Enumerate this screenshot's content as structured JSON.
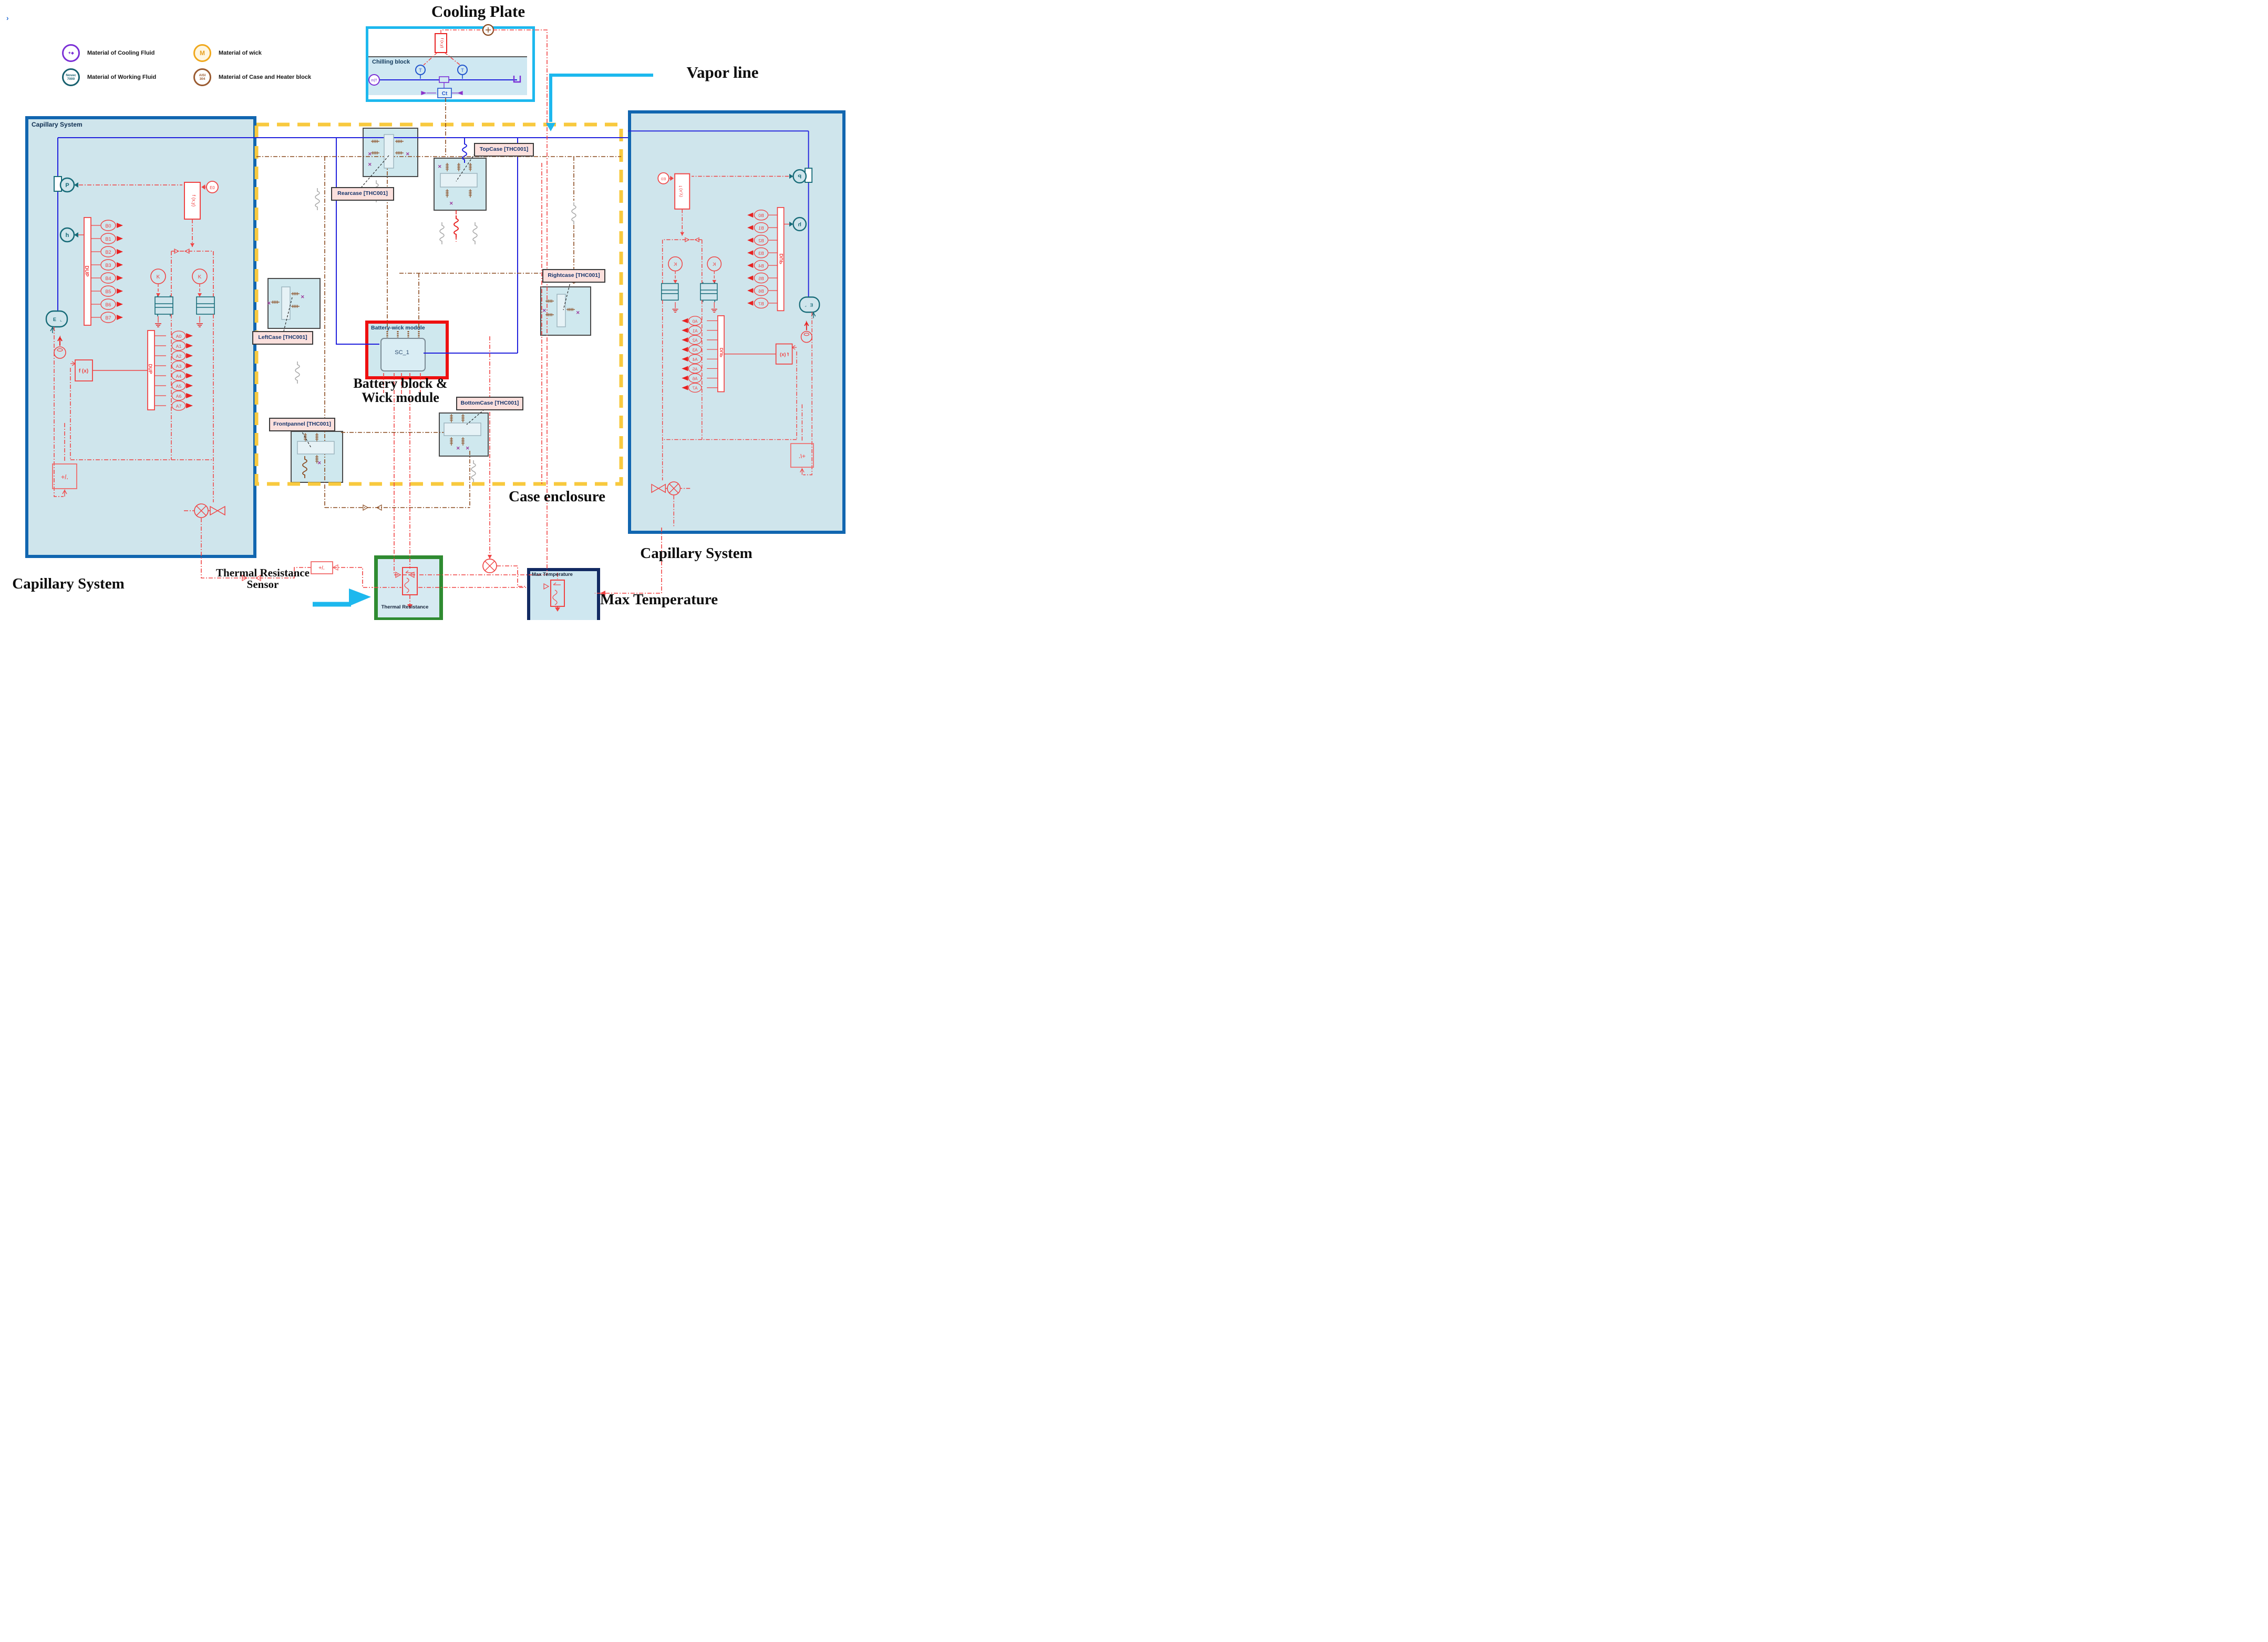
{
  "artifact": {
    "cursor": "›"
  },
  "titles": {
    "cooling_plate": "Cooling Plate",
    "vapor_line": "Vapor line",
    "case_enclosure": "Case enclosure",
    "battery_line1": "Battery block &",
    "battery_line2": "Wick module",
    "capillary_left": "Capillary System",
    "capillary_right": "Capillary System",
    "max_temperature": "Max Temperature",
    "thermal_sensor_line1": "Thermal Resistance",
    "thermal_sensor_line2": "Sensor"
  },
  "legend": {
    "items": [
      {
        "name": "cooling-fluid",
        "badge_line1": "",
        "badge_line2": "",
        "label": "Material of Cooling Fluid"
      },
      {
        "name": "working-fluid",
        "badge_line1": "Novec",
        "badge_line2": "7000",
        "label": "Material of Working Fluid"
      },
      {
        "name": "wick",
        "badge_line1": "M",
        "badge_line2": "",
        "label": "Material of wick"
      },
      {
        "name": "case-heater",
        "badge_line1": "AISI",
        "badge_line2": "304",
        "label": "Material of Case and Heater block"
      }
    ]
  },
  "cooling_plate": {
    "chilling_block": "Chilling block",
    "ct": "Ct",
    "t1": "T",
    "t2": "T",
    "fxy": "f (x,y)"
  },
  "enclosure": {
    "rearcase": "Rearcase [THC001]",
    "topcase": "TopCase [THC001]",
    "leftcase": "LeftCase [THC001]",
    "rightcase": "Rightcase [THC001]",
    "bottomcase": "BottomCase [THC001]",
    "frontpannel": "Frontpannel [THC001]"
  },
  "battery": {
    "module": "Battery-wick module",
    "sc": "SC_1"
  },
  "capillary": {
    "title": "Capillary System",
    "dup_b": "DUP",
    "dup_a": "DUP",
    "p": "P",
    "h": "h",
    "k1": "K",
    "k2": "K",
    "e0": "E0",
    "fxy": "f (x,y)",
    "fx": "f (x)",
    "sum": "+/.",
    "e": "E",
    "b": [
      "B0",
      "B1",
      "B2",
      "B3",
      "B4",
      "B5",
      "B6",
      "B7"
    ],
    "a": [
      "A0",
      "A1",
      "A2",
      "A3",
      "A4",
      "A5",
      "A6",
      "A7"
    ]
  },
  "bottom": {
    "sum": "+/."
  },
  "sensors": {
    "thermal_resistance": "Thermal Resistance",
    "max_temperature": "Max Temperature"
  },
  "colors": {
    "cyan": "#1db8ee",
    "enclosure_yellow": "#f8c93e",
    "capillary_border": "#1166b0",
    "capillary_fill": "#cfe5ec",
    "battery_red": "#ee1010",
    "green_box": "#2f8b31",
    "navy_box": "#122a62",
    "wire_red": "#f04343",
    "wire_brown": "#8a4a1f",
    "wire_blue": "#2121dd",
    "teal": "#176b78"
  }
}
